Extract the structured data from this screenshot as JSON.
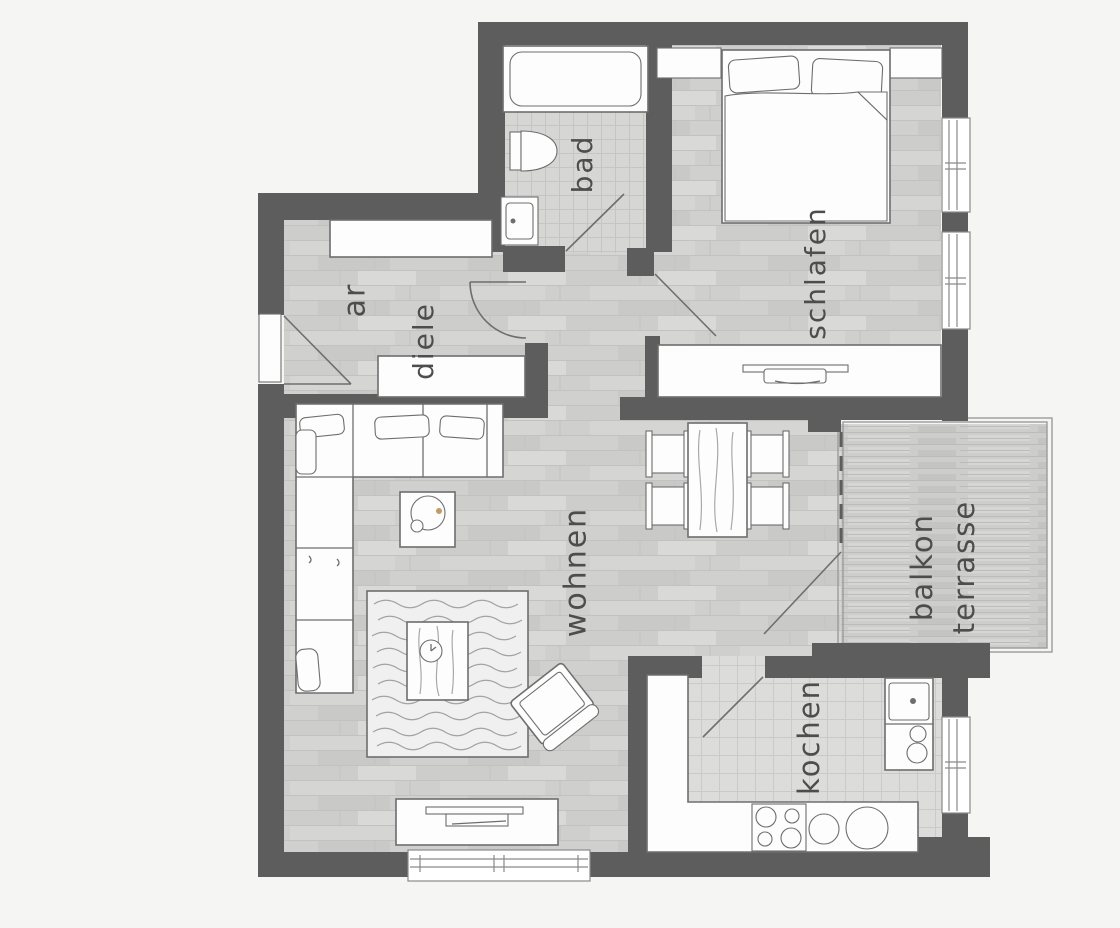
{
  "title": "apartment-floor-plan",
  "colors": {
    "background": "#f5f5f4",
    "wall": "#5d5d5d",
    "outline": "#6e6e6e",
    "furniture_fill": "#fdfdfd",
    "label": "#4d4d4d",
    "rug_fill": "#f0f0f0",
    "accent_dot": "#c49a66"
  },
  "rooms": {
    "bad": {
      "label": "bad"
    },
    "schlafen": {
      "label": "schlafen"
    },
    "ar": {
      "label": "ar"
    },
    "diele": {
      "label": "diele"
    },
    "wohnen": {
      "label": "wohnen"
    },
    "kochen": {
      "label": "kochen"
    },
    "balkon": {
      "label_line1": "balkon",
      "label_line2": "terrasse"
    }
  }
}
